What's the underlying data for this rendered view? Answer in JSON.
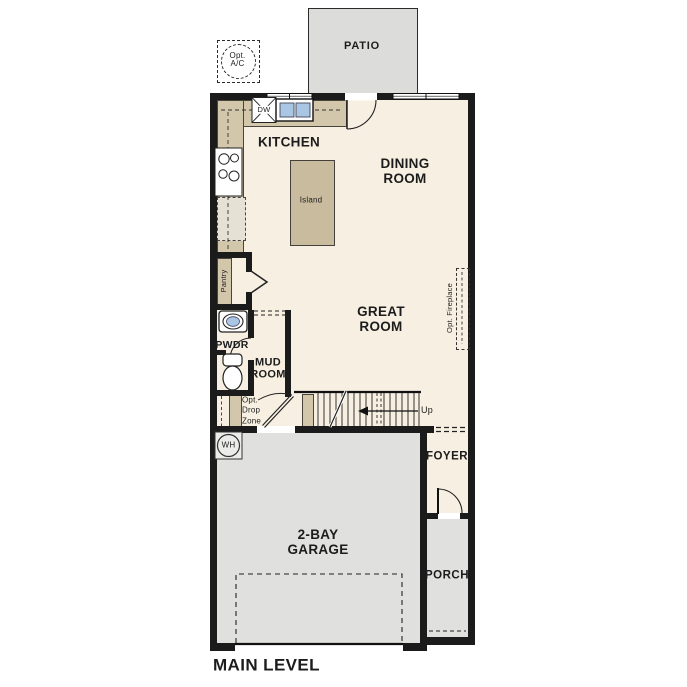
{
  "plan": {
    "level_label": "MAIN LEVEL",
    "rooms": {
      "patio": "PATIO",
      "kitchen": "KITCHEN",
      "dining_room": "DINING ROOM",
      "great_room": "GREAT ROOM",
      "mud_room": "MUD ROOM",
      "powder": "PWDR",
      "pantry": "Pantry",
      "foyer": "FOYER",
      "porch": "PORCH",
      "garage": "2-BAY GARAGE"
    },
    "features": {
      "island": "Island",
      "dishwasher": "DW",
      "water_heater": "WH",
      "stairs_up": "Up",
      "opt_ac": "Opt. A/C",
      "opt_ref": "Opt. Ref",
      "opt_drop_zone": "Opt. Drop Zone",
      "opt_fireplace": "Opt. Fireplace"
    }
  },
  "colors": {
    "wall": "#1b1b1b",
    "floor": "#f7f0e2",
    "counter": "#d3c7ab",
    "island": "#c8bb9e",
    "gray": "#e0e0df",
    "patio": "#dcdcdb",
    "sink": "#a9c7e5",
    "line": "#222222",
    "text": "#1c1c1c"
  }
}
